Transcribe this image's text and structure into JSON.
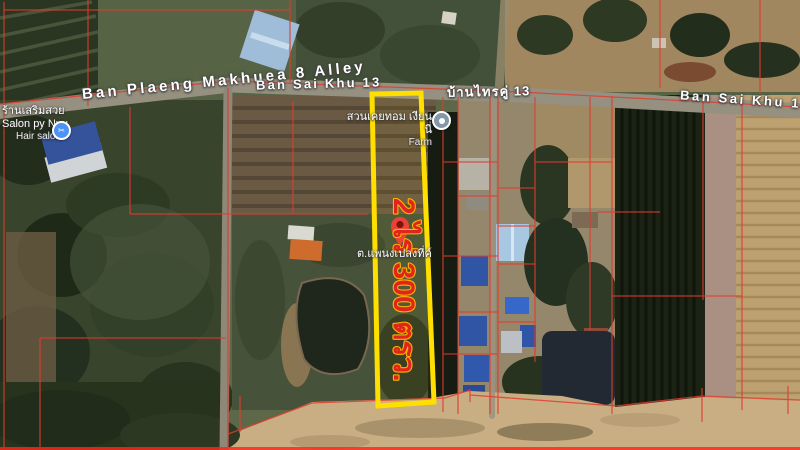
{
  "map": {
    "road_labels": [
      {
        "text": "Ban Plaeng Makhuea 8 Alley"
      },
      {
        "text": "Ban Sai Khu 13"
      },
      {
        "text": "บ้านไทรคู่ 13"
      },
      {
        "text": "Ban Sai Khu 13"
      }
    ],
    "places": {
      "salon": {
        "thai_name": "ร้านเสริมสวย",
        "latin_name": "Salon py Nuu",
        "category": "Hair salon",
        "icon_color": "#4d94f2"
      },
      "farm": {
        "thai_name": "สวนเคยทอม เงียนนี่",
        "category": "Farm",
        "icon_color": "#8498aa"
      }
    },
    "pin": {
      "label": "ต.แพนงเปลงที่ค์",
      "color": "#ea4335"
    },
    "parcel": {
      "area_text": "2 ไร่ 300 ตรว.",
      "outline_color": "#ffdf00",
      "text_fill": "#e0261c",
      "text_stroke": "#ffb200"
    },
    "cadastral_line_color": "#e23b2e"
  }
}
